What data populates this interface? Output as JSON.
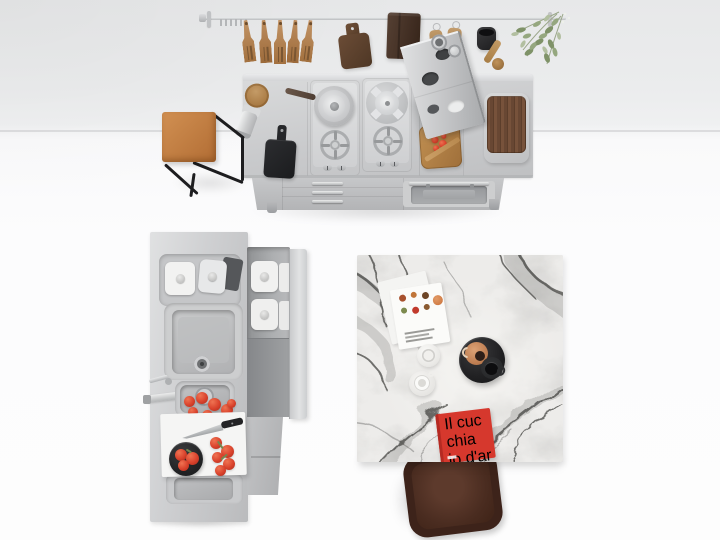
{
  "scene": {
    "description": "Overhead studio photograph of a stainless steel modular kitchen: wall rail with wooden utensils, island with two gas hobs and oven, tall sink unit with open drawer of containers, cognac leather stool, grey marble table with coffee tray and red cookbook, brown upholstered chair",
    "wall_color": "#ebeced",
    "floor_color": "#fcfcfd"
  },
  "palette": {
    "steel_light": "#dcdddf",
    "steel_mid": "#c7c8ca",
    "steel_dark": "#a9abad",
    "wood": "#b58557",
    "walnut": "#6b4a33",
    "black_tool": "#232426",
    "leather": "#c8813f",
    "tomato_red": "#d8452f",
    "marble_base": "#eceae7",
    "marble_vein": "#3e3e3c",
    "book_red": "#d6382d",
    "chair_brown": "#4a2d22",
    "plant_green": "#8a9a74"
  },
  "cookbook": {
    "title_lines": [
      "Il",
      "cuc",
      "chia",
      "io",
      "d'ar",
      "gen",
      "to."
    ]
  },
  "objects": {
    "rail": "steel utensil rail",
    "spatulas": "five wooden spatulas",
    "hanging_board": "hanging walnut chopping board",
    "towel": "dark brown towel",
    "brushes": "two wooden brushes",
    "cup_and_scoop": "black cup with wooden scoop",
    "plant": "hanging green sprigs",
    "wall_shelf": "tilted steel wall shelf",
    "island": "steel island, two gas hobs, oven, drawers",
    "stool": "cognac leather stool with black frame",
    "sink_unit": "tall steel sink unit with open drawer",
    "table": "square grey marble table",
    "tray": "black tray with terracotta jug and black mug",
    "chair": "dark brown upholstered chair"
  }
}
